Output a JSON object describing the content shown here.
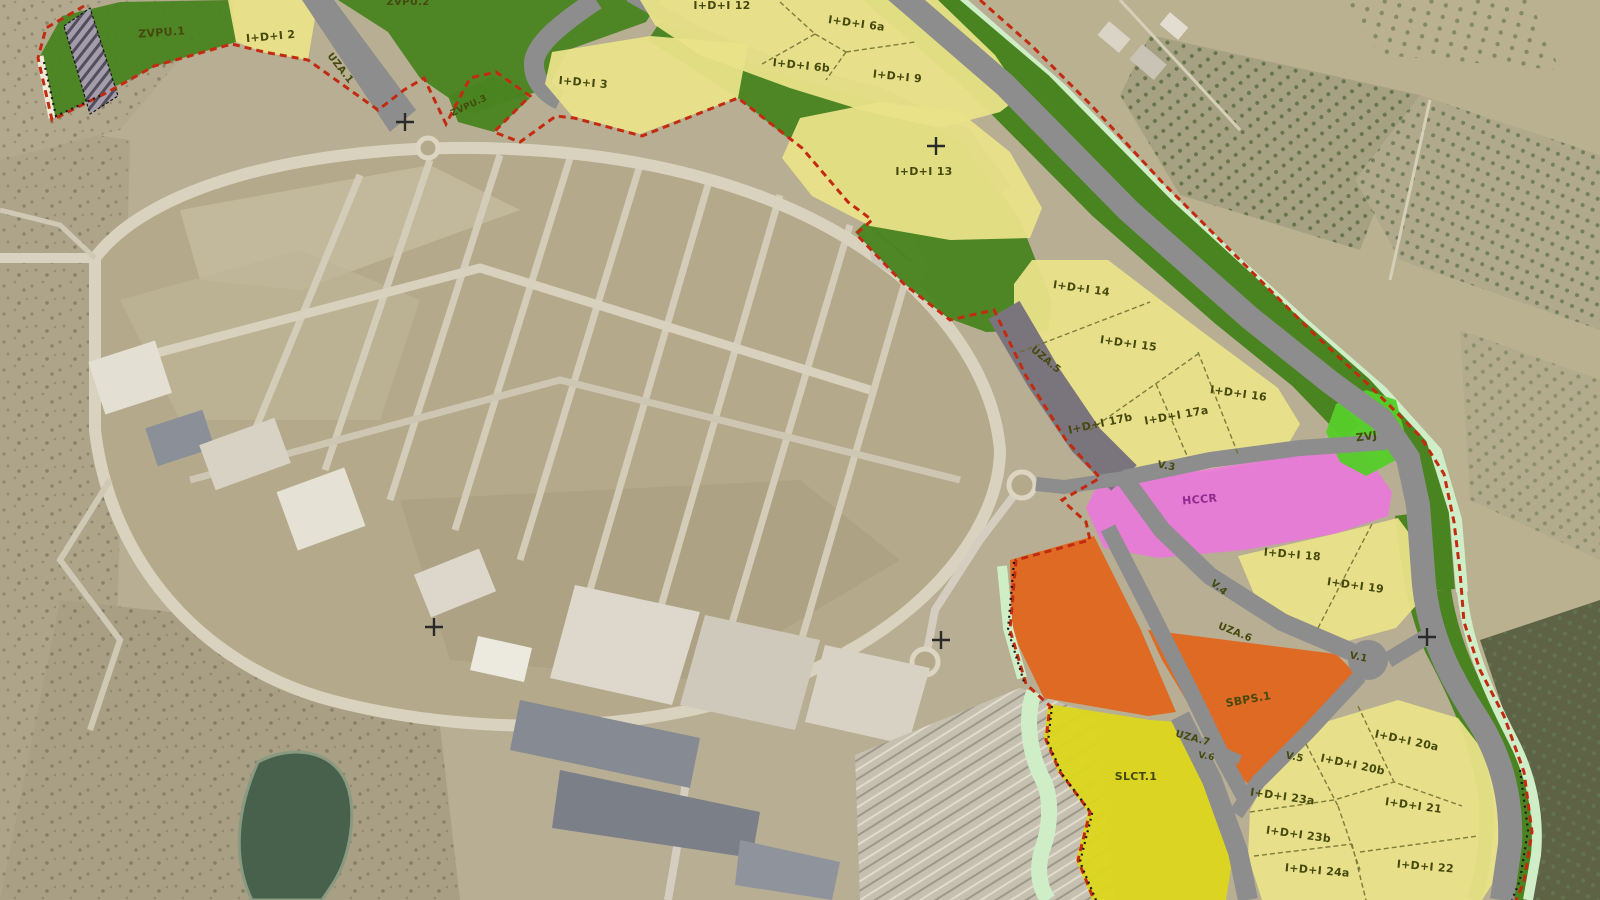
{
  "map": {
    "type": "urban zoning plan overlaid on aerial photograph",
    "labels": [
      {
        "id": "zvpu-2",
        "text": "ZVPU.2"
      },
      {
        "id": "zvpu-1",
        "text": "ZVPU.1"
      },
      {
        "id": "idi-2",
        "text": "I+D+I 2"
      },
      {
        "id": "uza-1",
        "text": "UZA.1"
      },
      {
        "id": "zvpu-3",
        "text": "ZVPU.3"
      },
      {
        "id": "idi-3",
        "text": "I+D+I 3"
      },
      {
        "id": "idi-12",
        "text": "I+D+I 12"
      },
      {
        "id": "idi-6a",
        "text": "I+D+I 6a"
      },
      {
        "id": "idi-6b",
        "text": "I+D+I 6b"
      },
      {
        "id": "idi-9",
        "text": "I+D+I 9"
      },
      {
        "id": "idi-13",
        "text": "I+D+I 13"
      },
      {
        "id": "idi-14",
        "text": "I+D+I 14"
      },
      {
        "id": "idi-15",
        "text": "I+D+I 15"
      },
      {
        "id": "uza-5",
        "text": "UZA.5"
      },
      {
        "id": "idi-16",
        "text": "I+D+I 16"
      },
      {
        "id": "idi-17b",
        "text": "I+D+I 17b"
      },
      {
        "id": "idi-17a",
        "text": "I+D+I 17a"
      },
      {
        "id": "zvj",
        "text": "ZVJ"
      },
      {
        "id": "v-3",
        "text": "V.3"
      },
      {
        "id": "hccr",
        "text": "HCCR"
      },
      {
        "id": "idi-18",
        "text": "I+D+I 18"
      },
      {
        "id": "idi-19",
        "text": "I+D+I 19"
      },
      {
        "id": "v-4",
        "text": "V.4"
      },
      {
        "id": "uza-6",
        "text": "UZA.6"
      },
      {
        "id": "v-1",
        "text": "V.1"
      },
      {
        "id": "sbps-1",
        "text": "SBPS.1"
      },
      {
        "id": "uza-7",
        "text": "UZA.7"
      },
      {
        "id": "v-6",
        "text": "V.6"
      },
      {
        "id": "v-5",
        "text": "V.5"
      },
      {
        "id": "slct-1",
        "text": "SLCT.1"
      },
      {
        "id": "idi-20a",
        "text": "I+D+I 20a"
      },
      {
        "id": "idi-20b",
        "text": "I+D+I 20b"
      },
      {
        "id": "idi-23a",
        "text": "I+D+I 23a"
      },
      {
        "id": "idi-21",
        "text": "I+D+I 21"
      },
      {
        "id": "idi-23b",
        "text": "I+D+I 23b"
      },
      {
        "id": "idi-24a",
        "text": "I+D+I 24a"
      },
      {
        "id": "idi-22",
        "text": "I+D+I 22"
      }
    ],
    "colors": {
      "parcel_yellow": "#e9e288",
      "facility_yellow": "#dcd61c",
      "green_zone": "#4a8420",
      "bright_green_zvj": "#55cd2a",
      "mint_strip": "#cfeec8",
      "pink_hccr": "#e87ad9",
      "orange_zone": "#e0661c",
      "road_gray": "#8d8d8d",
      "road_dark_gray": "#7a757d",
      "boundary_red": "#c32b10",
      "boundary_black": "#1a1a1a",
      "label_dark_olive": "#45490e",
      "aerial_tan": "#b7ae93"
    }
  }
}
